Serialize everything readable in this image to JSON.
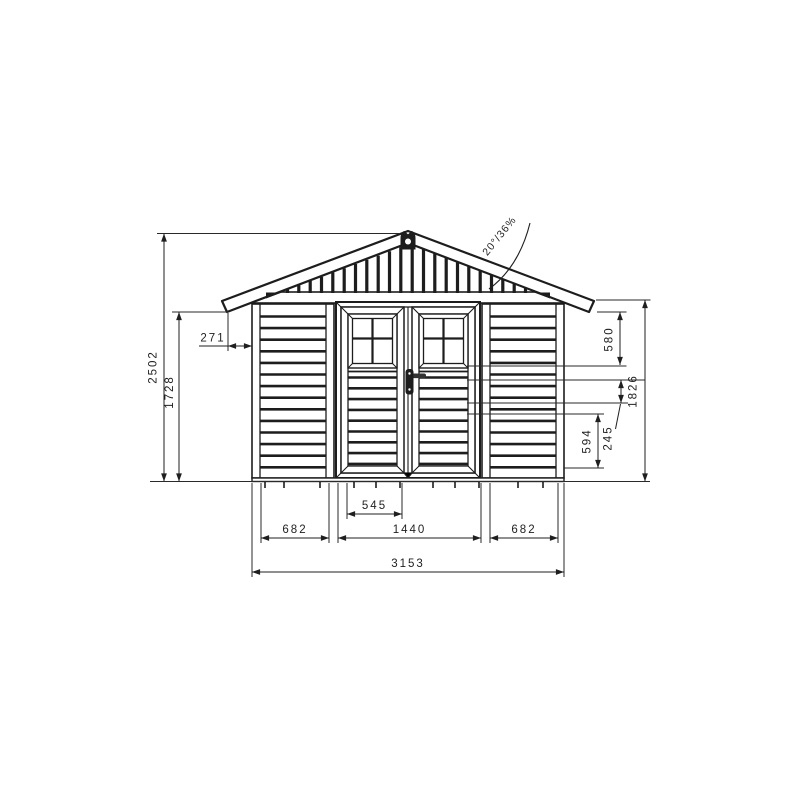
{
  "drawing": {
    "type": "shed-front-elevation",
    "background": "#ffffff",
    "line_color": "#1d1d1d"
  },
  "dimensions": {
    "height_total": "2502",
    "height_eave": "1728",
    "overhang": "271",
    "right_580": "580",
    "right_1826": "1826",
    "right_245": "245",
    "right_594": "594",
    "bottom_545": "545",
    "bottom_682_left": "682",
    "bottom_1440": "1440",
    "bottom_682_right": "682",
    "bottom_3153": "3153",
    "roof_pitch": "20°/36%"
  }
}
